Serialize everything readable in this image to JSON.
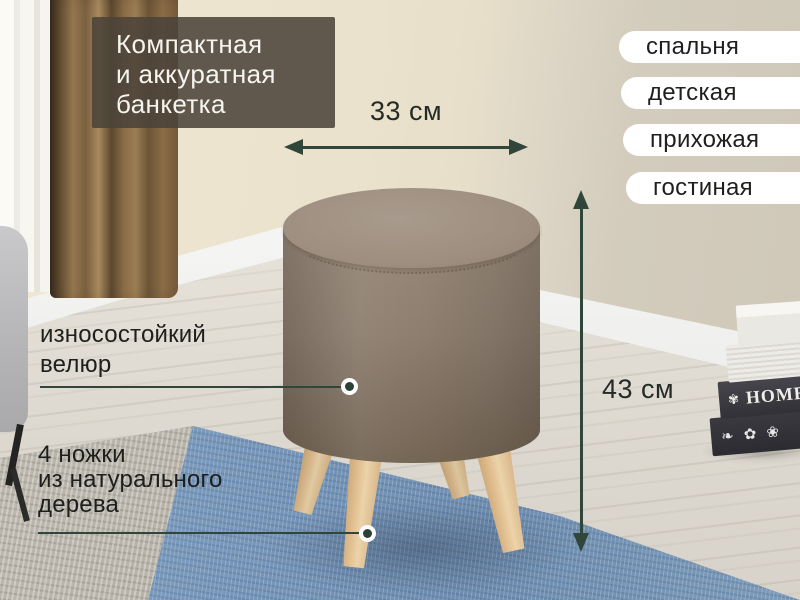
{
  "title": {
    "line1": "Компактная",
    "line2": "и аккуратная",
    "line3": "банкетка"
  },
  "room_tags": {
    "items": [
      {
        "label": "спальня"
      },
      {
        "label": "детская"
      },
      {
        "label": "прихожая"
      },
      {
        "label": "гостиная"
      }
    ]
  },
  "dimensions": {
    "width_label": "33 см",
    "height_label": "43 см"
  },
  "features": {
    "upholstery": {
      "line1": "износостойкий",
      "line2": "велюр"
    },
    "legs": {
      "line1": "4 ножки",
      "line2": "из натурального",
      "line3": "дерева"
    }
  },
  "decor": {
    "book_spine_text": "HOME",
    "book_ornament_glyph": "✾",
    "book_floral_glyphs": "❧ ✿ ❀"
  },
  "colors": {
    "accent_green": "#31463a",
    "overlay_bg": "#4b433a",
    "pill_bg": "#ffffff",
    "text_dark": "#1d1f1c",
    "text_light": "#f6f4ef",
    "pouf_fabric": "#8d7e6f",
    "leg_wood": "#e2c092",
    "rug_blue": "#7897ba",
    "rug_grey": "#aaa69c",
    "wall_cream": "#eae2cc",
    "wall_grey": "#cfc8b9"
  }
}
